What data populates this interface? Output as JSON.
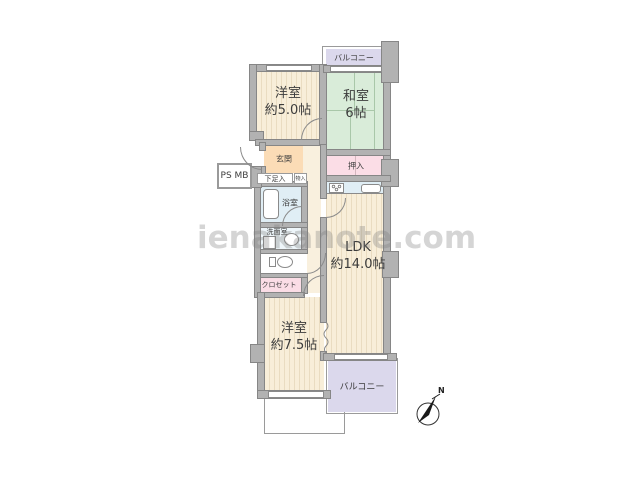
{
  "watermark": {
    "text": "ienakanote.com"
  },
  "compass": {
    "north_label": "N"
  },
  "rooms": {
    "balcony_top": {
      "label": "バルコニー"
    },
    "west_room_1": {
      "name": "洋室",
      "size": "約5.0帖"
    },
    "japanese_room": {
      "name": "和室",
      "size": "6帖"
    },
    "oshiire": {
      "label": "押入"
    },
    "genkan": {
      "label": "玄関"
    },
    "shoe_cabinet": {
      "label": "下足入"
    },
    "small_storage": {
      "label": "物入"
    },
    "ps_mb": {
      "label": "PS MB"
    },
    "bathroom": {
      "label": "浴室"
    },
    "washroom": {
      "label": "洗面室"
    },
    "closet": {
      "label": "クロゼット"
    },
    "ldk": {
      "name": "LDK",
      "size": "約14.0帖"
    },
    "west_room_2": {
      "name": "洋室",
      "size": "約7.5帖"
    },
    "balcony_bottom": {
      "label": "バルコニー"
    }
  },
  "colors": {
    "room_cream": "#f8eed9",
    "tatami_green": "#d9ecd9",
    "closet_pink": "#fbdde6",
    "balcony_lavender": "#dbd8ec",
    "genkan_peach": "#fbdcb6",
    "wet_area_blue": "#e0eef5",
    "wall_gray": "#b2b2b2",
    "watermark_gray": "#c9c9c9"
  }
}
